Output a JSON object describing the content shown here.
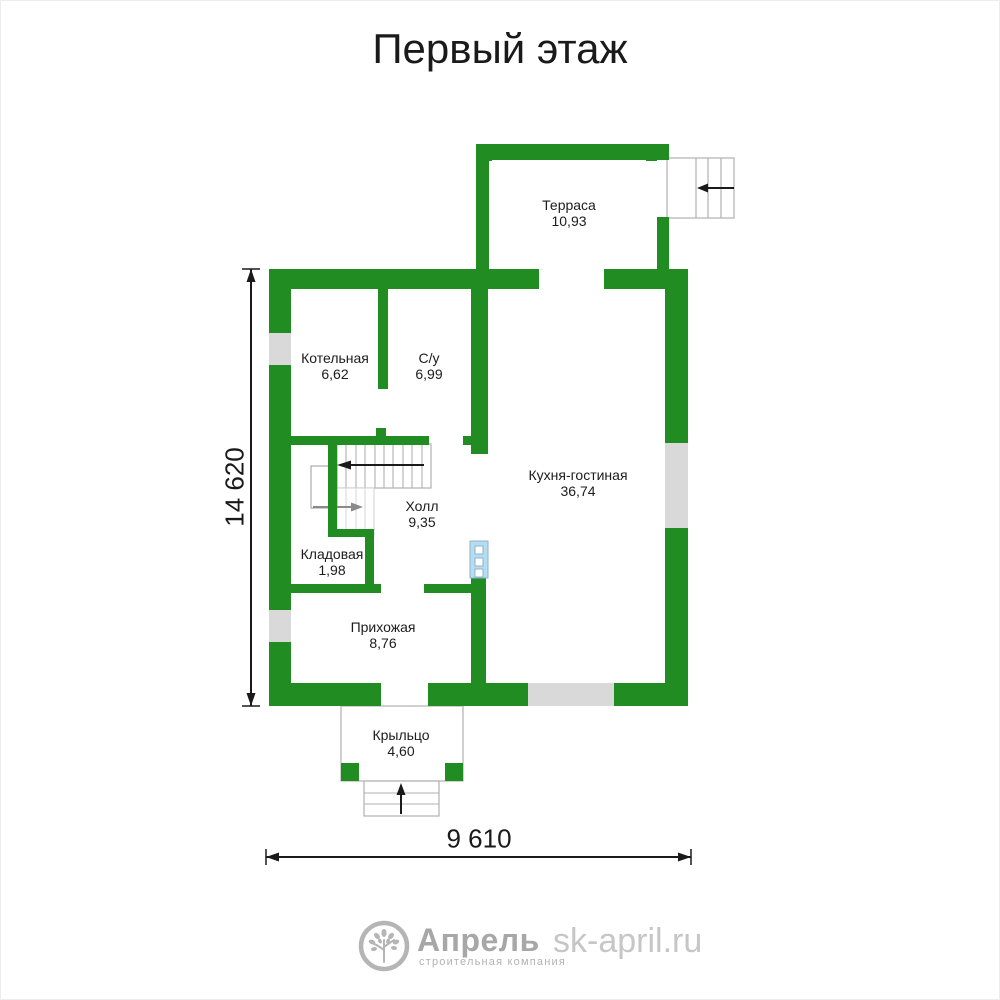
{
  "page": {
    "title": "Первый этаж"
  },
  "plan": {
    "rooms": [
      {
        "id": "terrace",
        "name": "Терраса",
        "area": "10,93"
      },
      {
        "id": "boiler",
        "name": "Котельная",
        "area": "6,62"
      },
      {
        "id": "bathroom",
        "name": "С/у",
        "area": "6,99"
      },
      {
        "id": "kitchen",
        "name": "Кухня-гостиная",
        "area": "36,74"
      },
      {
        "id": "hall",
        "name": "Холл",
        "area": "9,35"
      },
      {
        "id": "storage",
        "name": "Кладовая",
        "area": "1,98"
      },
      {
        "id": "entry",
        "name": "Прихожая",
        "area": "8,76"
      },
      {
        "id": "porch",
        "name": "Крыльцо",
        "area": "4,60"
      }
    ],
    "dimensions": {
      "height": "14 620",
      "width": "9 610"
    },
    "colors": {
      "wall_green": "#218c21",
      "window_gray": "#d9d9d9",
      "fixture_blue": "#b5ddf2",
      "stair_line": "#b0b0b0",
      "arrow_black": "#1a1a1a",
      "arrow_gray": "#8a8a8a"
    }
  },
  "footer": {
    "brand": "Апрель",
    "tagline": "строительная компания",
    "website": "sk-april.ru"
  }
}
